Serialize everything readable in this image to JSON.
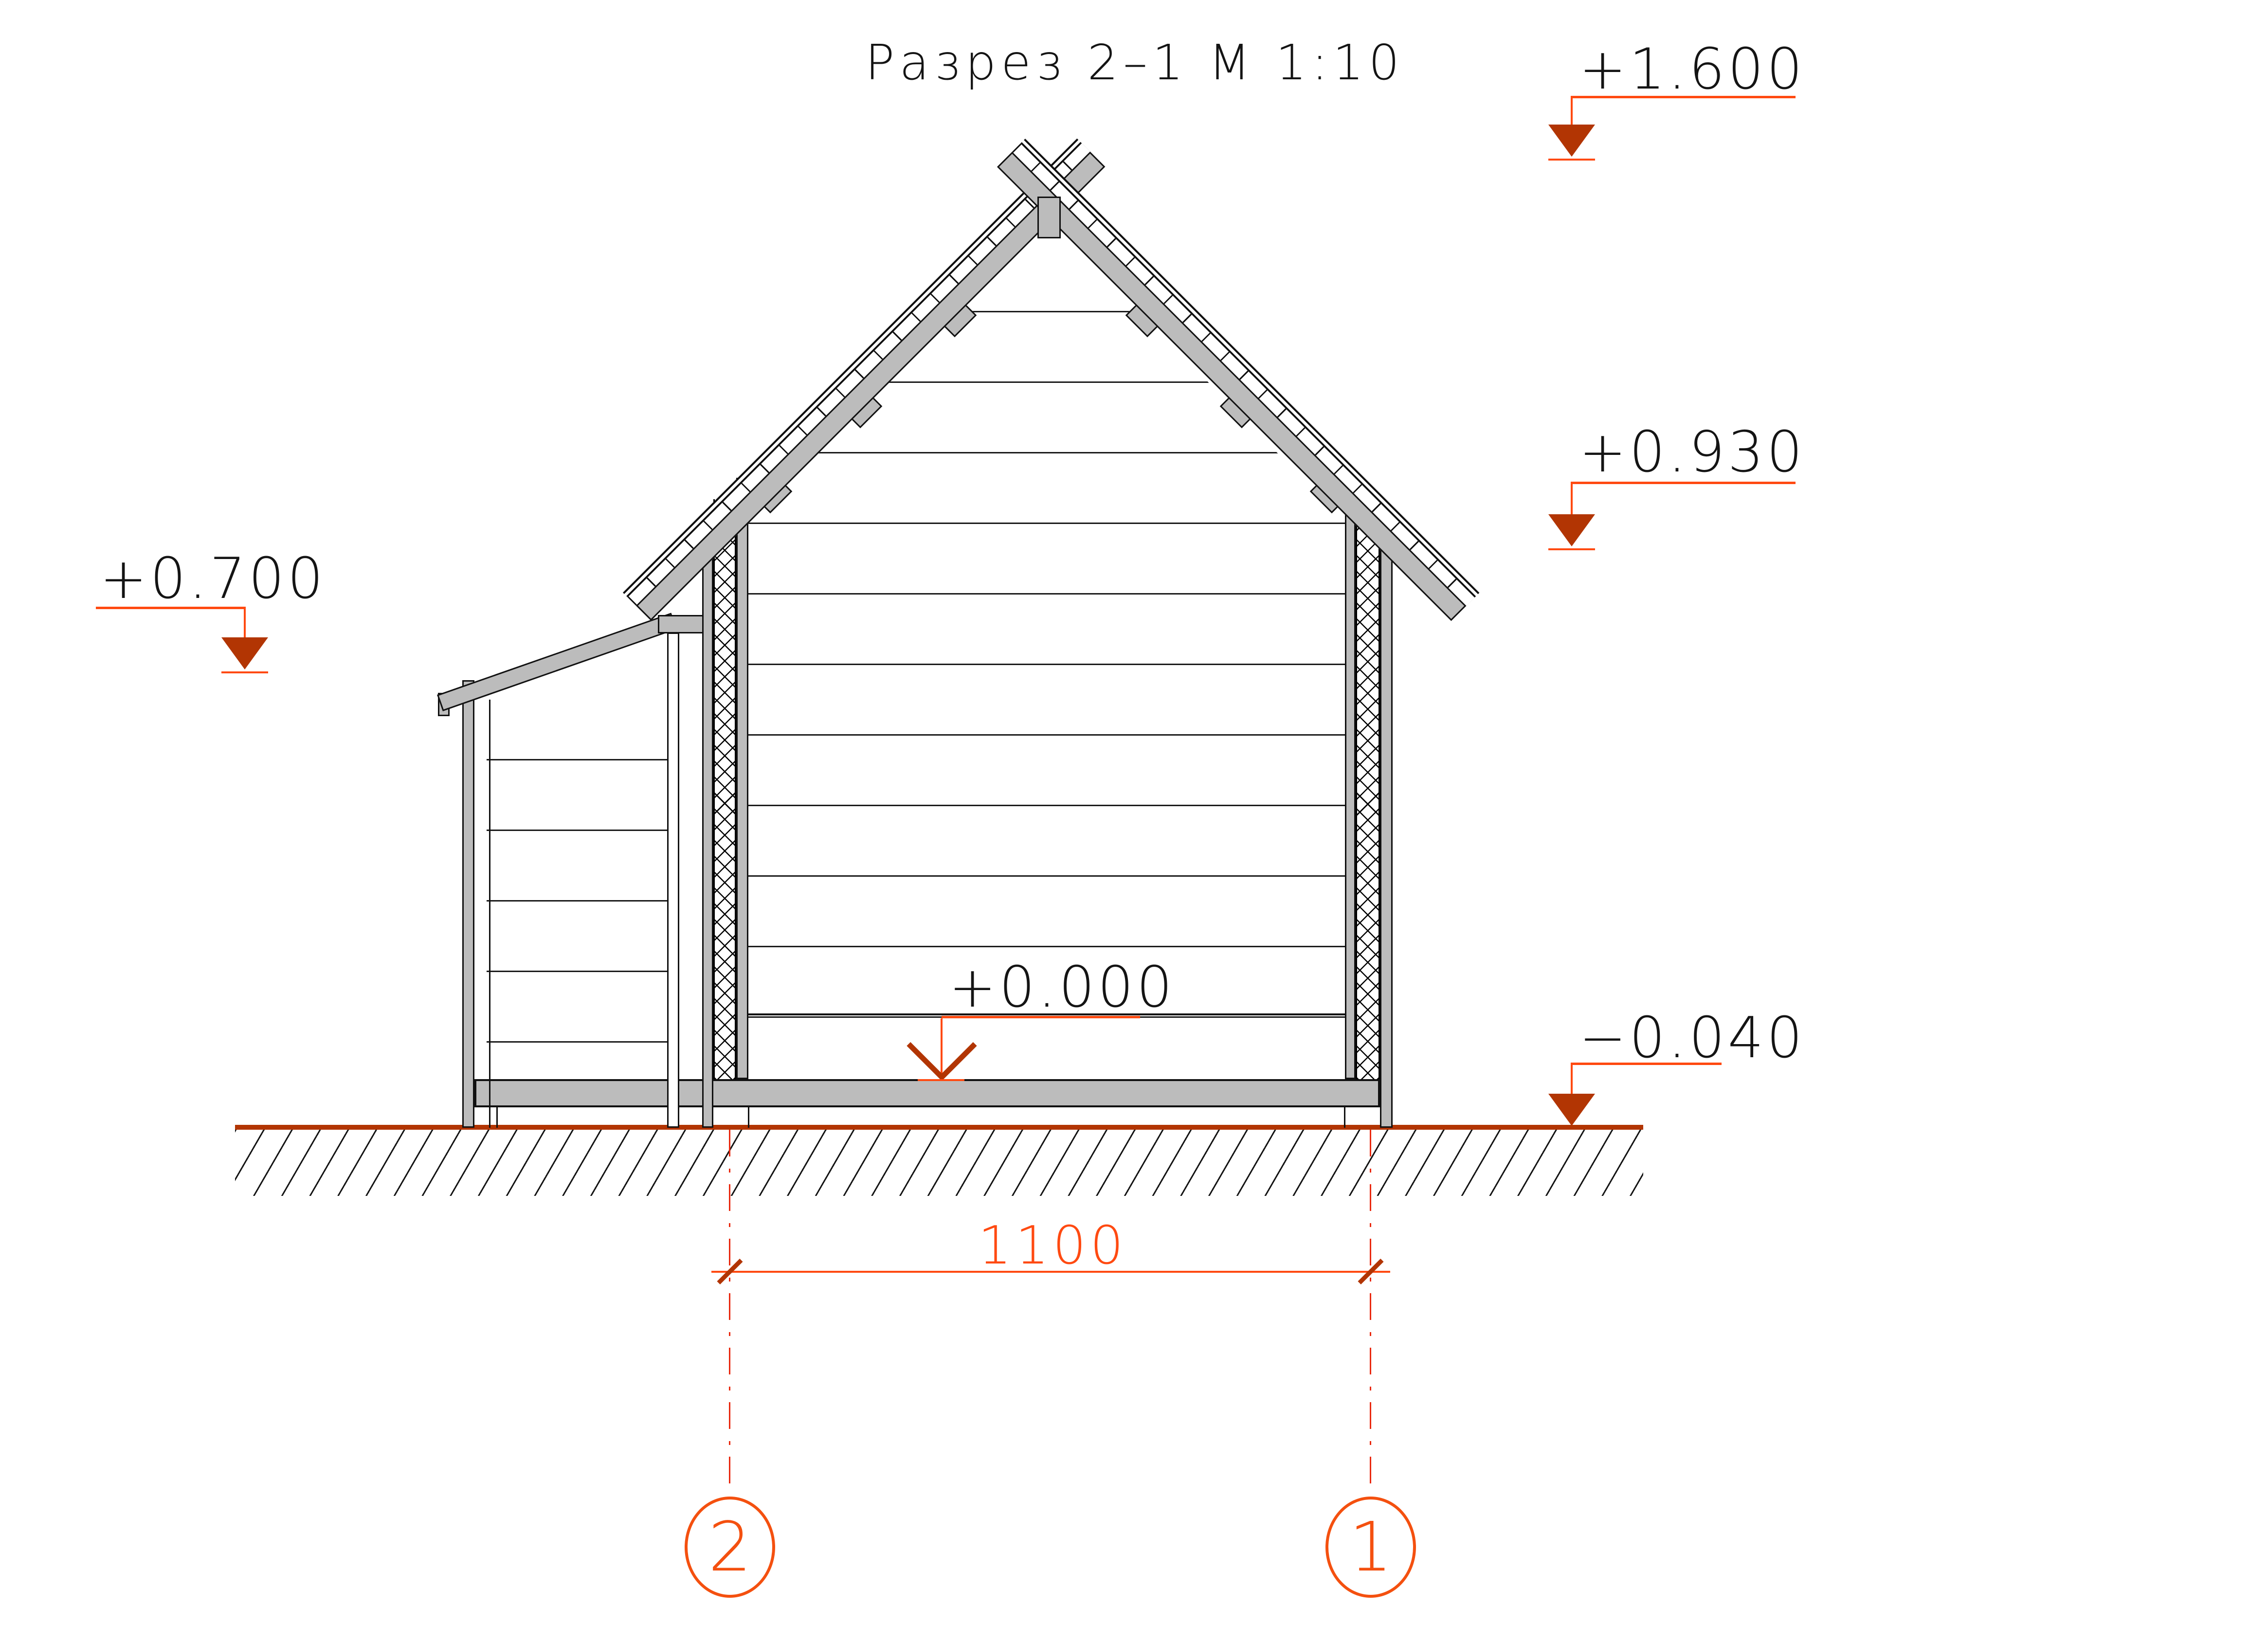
{
  "title": "Разрез 2–1  М 1:10",
  "levels": {
    "ridge": {
      "label": "+1.600"
    },
    "eaves": {
      "label": "+0.930"
    },
    "shed": {
      "label": "+0.700"
    },
    "floor": {
      "label": "+0.000"
    },
    "ground": {
      "label": "−0.040"
    }
  },
  "dimension": {
    "value": "1100"
  },
  "axes": {
    "left": "2",
    "right": "1"
  },
  "colors": {
    "annotation_orange": "#ff4a11",
    "marker_dark_red": "#b23503",
    "axis_dash_red": "#e92a10",
    "bubble_orange": "#f4500f",
    "line_black": "#111111",
    "wood_gray": "#bcbcbc"
  }
}
